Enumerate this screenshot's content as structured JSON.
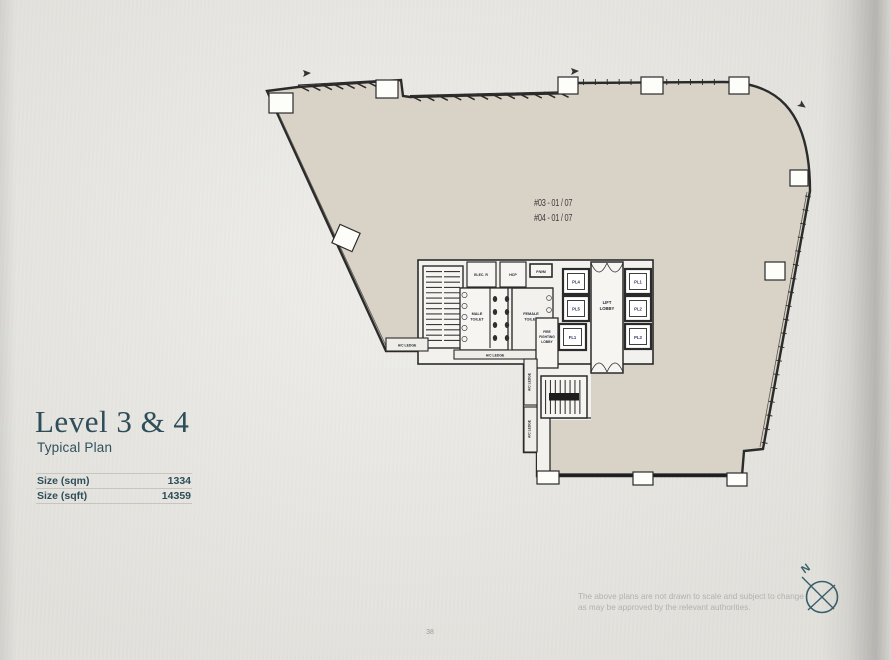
{
  "page": {
    "title": "Level 3 & 4",
    "subtitle": "Typical Plan",
    "size_table": [
      {
        "label": "Size (sqm)",
        "value": "1334"
      },
      {
        "label": "Size (sqft)",
        "value": "14359"
      }
    ],
    "disclaimer": [
      "The above plans are not drawn to scale and subject to change",
      "as may be approved by the relevant authorities."
    ],
    "page_number": "38",
    "compass_n": "N"
  },
  "plan": {
    "unit_numbers": [
      "#03 - 01 / 07",
      "#04 - 01 / 07"
    ],
    "rooms": {
      "lift_lobby": [
        "LIFT",
        "LOBBY"
      ],
      "male_toilet": [
        "MALE",
        "TOILET"
      ],
      "female_toilet": [
        "FEMALE",
        "TOILET"
      ],
      "fire_fighting_lobby": [
        "FIRE",
        "FIGHTING",
        "LOBBY"
      ],
      "hcp": "HCP",
      "elec_riser": "ELEC. R",
      "pwm": "P/WM",
      "ac_ledge": "A/C LEDGE"
    },
    "lifts": {
      "left": [
        "PL4",
        "PL5",
        "FL1"
      ],
      "right": [
        "PL1",
        "PL2",
        "PL3"
      ]
    }
  },
  "colors": {
    "accent": "#2e4d58",
    "plan_fill": "#d9d3c7",
    "core_fill": "#f2f1ed",
    "line": "#2b2b2b",
    "muted_text": "#b2b1ae"
  }
}
